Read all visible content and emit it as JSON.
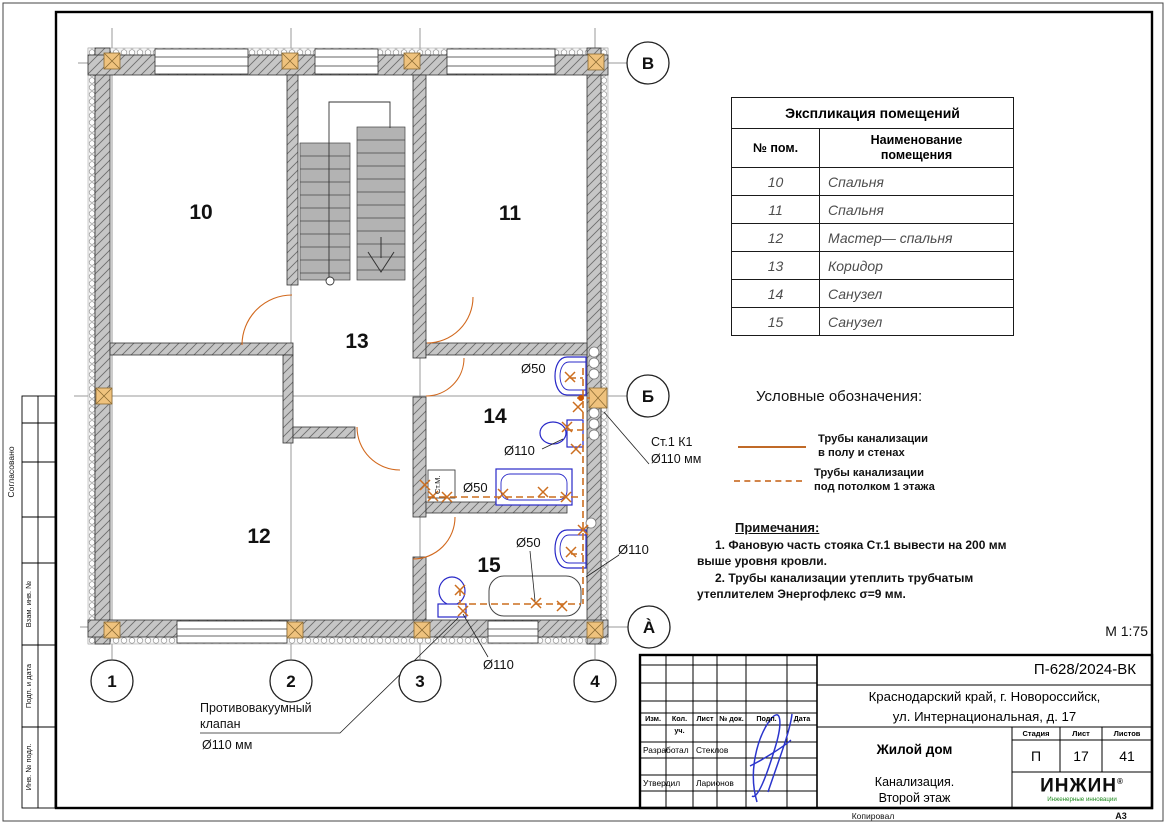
{
  "sheet": {
    "scale": "М 1:75",
    "format": "А3",
    "copied_by": "Копировал"
  },
  "colors": {
    "pipe_orange": "#cc6e1f",
    "fixture_blue": "#2929c8",
    "room_number_blue": "#1c1ca8",
    "block_orange": "#efc27d",
    "logo_green": "#1f8a1f"
  },
  "frame_strip": {
    "agreed": "Согласовано",
    "vzam": "Взам. инв. №",
    "podp": "Подп. и дата",
    "inv": "Инв. № подл."
  },
  "plan": {
    "rooms": {
      "r10": "10",
      "r11": "11",
      "r12": "12",
      "r13": "13",
      "r14": "14",
      "r15": "15"
    },
    "axes": {
      "top": "В",
      "mid": "Б",
      "bottom": "À",
      "c1": "1",
      "c2": "2",
      "c3": "3",
      "c4": "4"
    },
    "labels": {
      "d50": "Ø50",
      "d110": "Ø110",
      "riser1": "Ст.1 К1",
      "riser2": "Ø110 мм",
      "washer": "Ст.М.",
      "valve1": "Противовакуумный",
      "valve2": "клапан",
      "valve3": "Ø110 мм"
    }
  },
  "explication": {
    "title": "Экспликация помещений",
    "col_num": "№ пом.",
    "col_name": "Наименование помещения",
    "rows": [
      [
        "10",
        "Спальня"
      ],
      [
        "11",
        "Спальня"
      ],
      [
        "12",
        "Мастер— спальня"
      ],
      [
        "13",
        "Коридор"
      ],
      [
        "14",
        "Санузел"
      ],
      [
        "15",
        "Санузел"
      ]
    ]
  },
  "legend": {
    "title": "Условные обозначения:",
    "item1_line1": "Трубы канализации",
    "item1_line2": "в полу и стенах",
    "item2_line1": "Трубы канализации",
    "item2_line2": "под потолком 1 этажа"
  },
  "notes": {
    "title": "Примечания:",
    "n1": "1.    Фановую часть стояка Ст.1   вывести на 200 мм выше уровня кровли.",
    "n2": "2.    Трубы канализации утеплить трубчатым утеплителем Энергофлекс σ=9 мм."
  },
  "title_block": {
    "doc_number": "П-628/2024-ВК",
    "address1": "Краснодарский край, г. Новороссийск,",
    "address2": "ул. Интернациональная, д. 17",
    "object": "Жилой дом",
    "drawing1": "Канализация.",
    "drawing2": "Второй этаж",
    "stage_label": "Стадия",
    "sheet_label": "Лист",
    "sheets_label": "Листов",
    "stage": "П",
    "sheet_no": "17",
    "sheets_total": "41",
    "cols": {
      "izm": "Изм.",
      "kol": "Кол. уч.",
      "list": "Лист",
      "ndoc": "№ док.",
      "podp": "Подп.",
      "data": "Дата"
    },
    "role1": "Разработал",
    "name1": "Стеклов",
    "role2": "Утвердил",
    "name2": "Ларионов",
    "logo": "ИНЖИН",
    "logo_reg": "®",
    "logo_sub": "Инженерные инновации"
  }
}
